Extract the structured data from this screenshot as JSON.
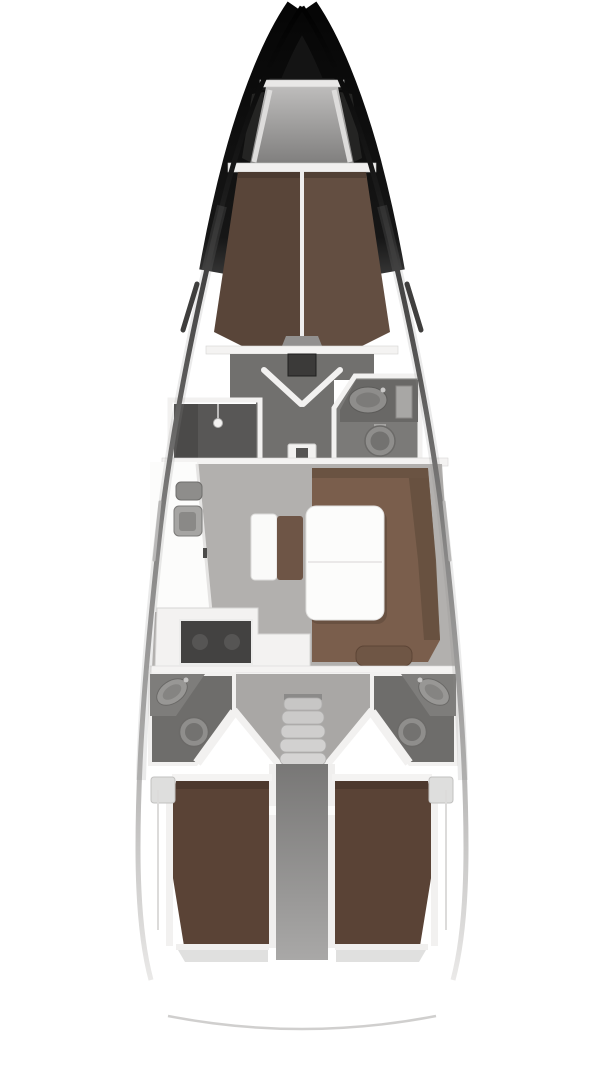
{
  "palette": {
    "page_bg": "#ffffff",
    "hull_dark": "#141414",
    "bow_wedge": "#242423",
    "locker_top_bar": "#e9e8e7",
    "locker_bottom_bar": "#f1f0ef",
    "rail_white": "#dddcdb",
    "vberth_brown_left": "#594539",
    "vberth_brown_right": "#634e41",
    "vberth_center_line": "#efeeee",
    "foot_step_gray": "#92908f",
    "bulkhead_white": "#f4f3f2",
    "lobby_gray": "#71706e",
    "mast_box": "#3b3a39",
    "door_white": "#f2f1f0",
    "shower_interior": "#585756",
    "shower_door_col": "#4b4a49",
    "shower_head_white": "#f4f3f2",
    "head_interior": "#7b7a78",
    "counter_gray": "#696866",
    "sink_gray": "#8e8d8b",
    "sink_inner": "#7c7b79",
    "cabinet_gray": "#a8a7a5",
    "toilet_gray": "#8f8e8c",
    "toilet_inner": "#737270",
    "salon_floor": "#b2b0ae",
    "settee_brown": "#7a5e4c",
    "settee_back": "#66503f",
    "settee_stub": "#6f5645",
    "table_white": "#fcfcfb",
    "bench_white": "#fafaf9",
    "bench_back_brown": "#6e5546",
    "fixture_gray_1": "#8e8d8b",
    "fixture_gray_2": "#a6a5a3",
    "galley_counter": "#f3f2f1",
    "cooktop_dark": "#434241",
    "aft_head_interior": "#6e6d6b",
    "aft_counter": "#7e7d7b",
    "stair_tread": "#cfcecd",
    "corridor_dark": "#787776",
    "corridor_light": "#a3a2a1",
    "aft_berth_brown": "#5a4336",
    "aft_berth_shadow": "#47342b",
    "locker_panel": "#dededd",
    "stern_arc": "#cbcac9",
    "window_slit": "#3f3e3d"
  },
  "diagram": {
    "type": "sailboat-interior-floor-plan",
    "orientation": "bow-up",
    "regions": [
      "bow",
      "anchor-locker",
      "v-berth-cabin",
      "shower-room",
      "forward-head",
      "salon",
      "salon-table",
      "chaise-bench",
      "galley",
      "companionway-stairs",
      "aft-port-head",
      "aft-starboard-head",
      "aft-port-cabin",
      "aft-starboard-cabin",
      "stern"
    ]
  }
}
